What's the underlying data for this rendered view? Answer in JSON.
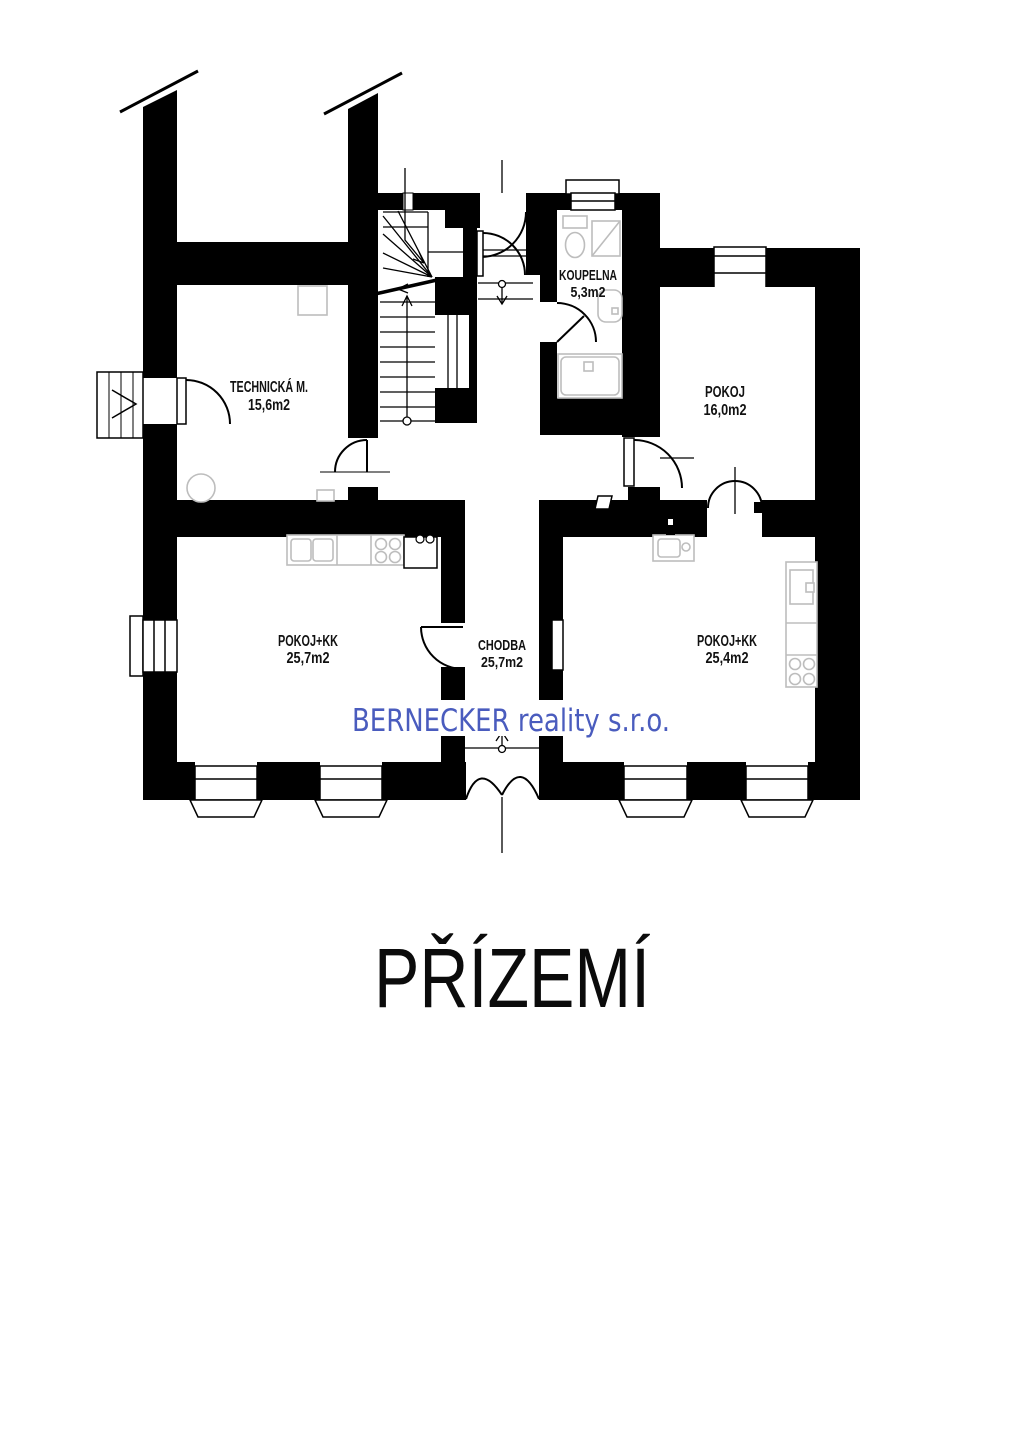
{
  "floor_plan": {
    "title": "PŘÍZEMÍ",
    "watermark": "BERNECKER reality s.r.o.",
    "colors": {
      "wall": "#000000",
      "background": "#ffffff",
      "fixture_outline": "#bdbdbd",
      "watermark_blue": "#4a5cbe"
    },
    "rooms": [
      {
        "name": "TECHNICKÁ M.",
        "area": "15,6m2"
      },
      {
        "name": "KOUPELNA",
        "area": "5,3m2"
      },
      {
        "name": "POKOJ",
        "area": "16,0m2"
      },
      {
        "name": "POKOJ+KK",
        "area": "25,7m2"
      },
      {
        "name": "CHODBA",
        "area": "25,7m2"
      },
      {
        "name": "POKOJ+KK",
        "area": "25,4m2"
      }
    ]
  }
}
